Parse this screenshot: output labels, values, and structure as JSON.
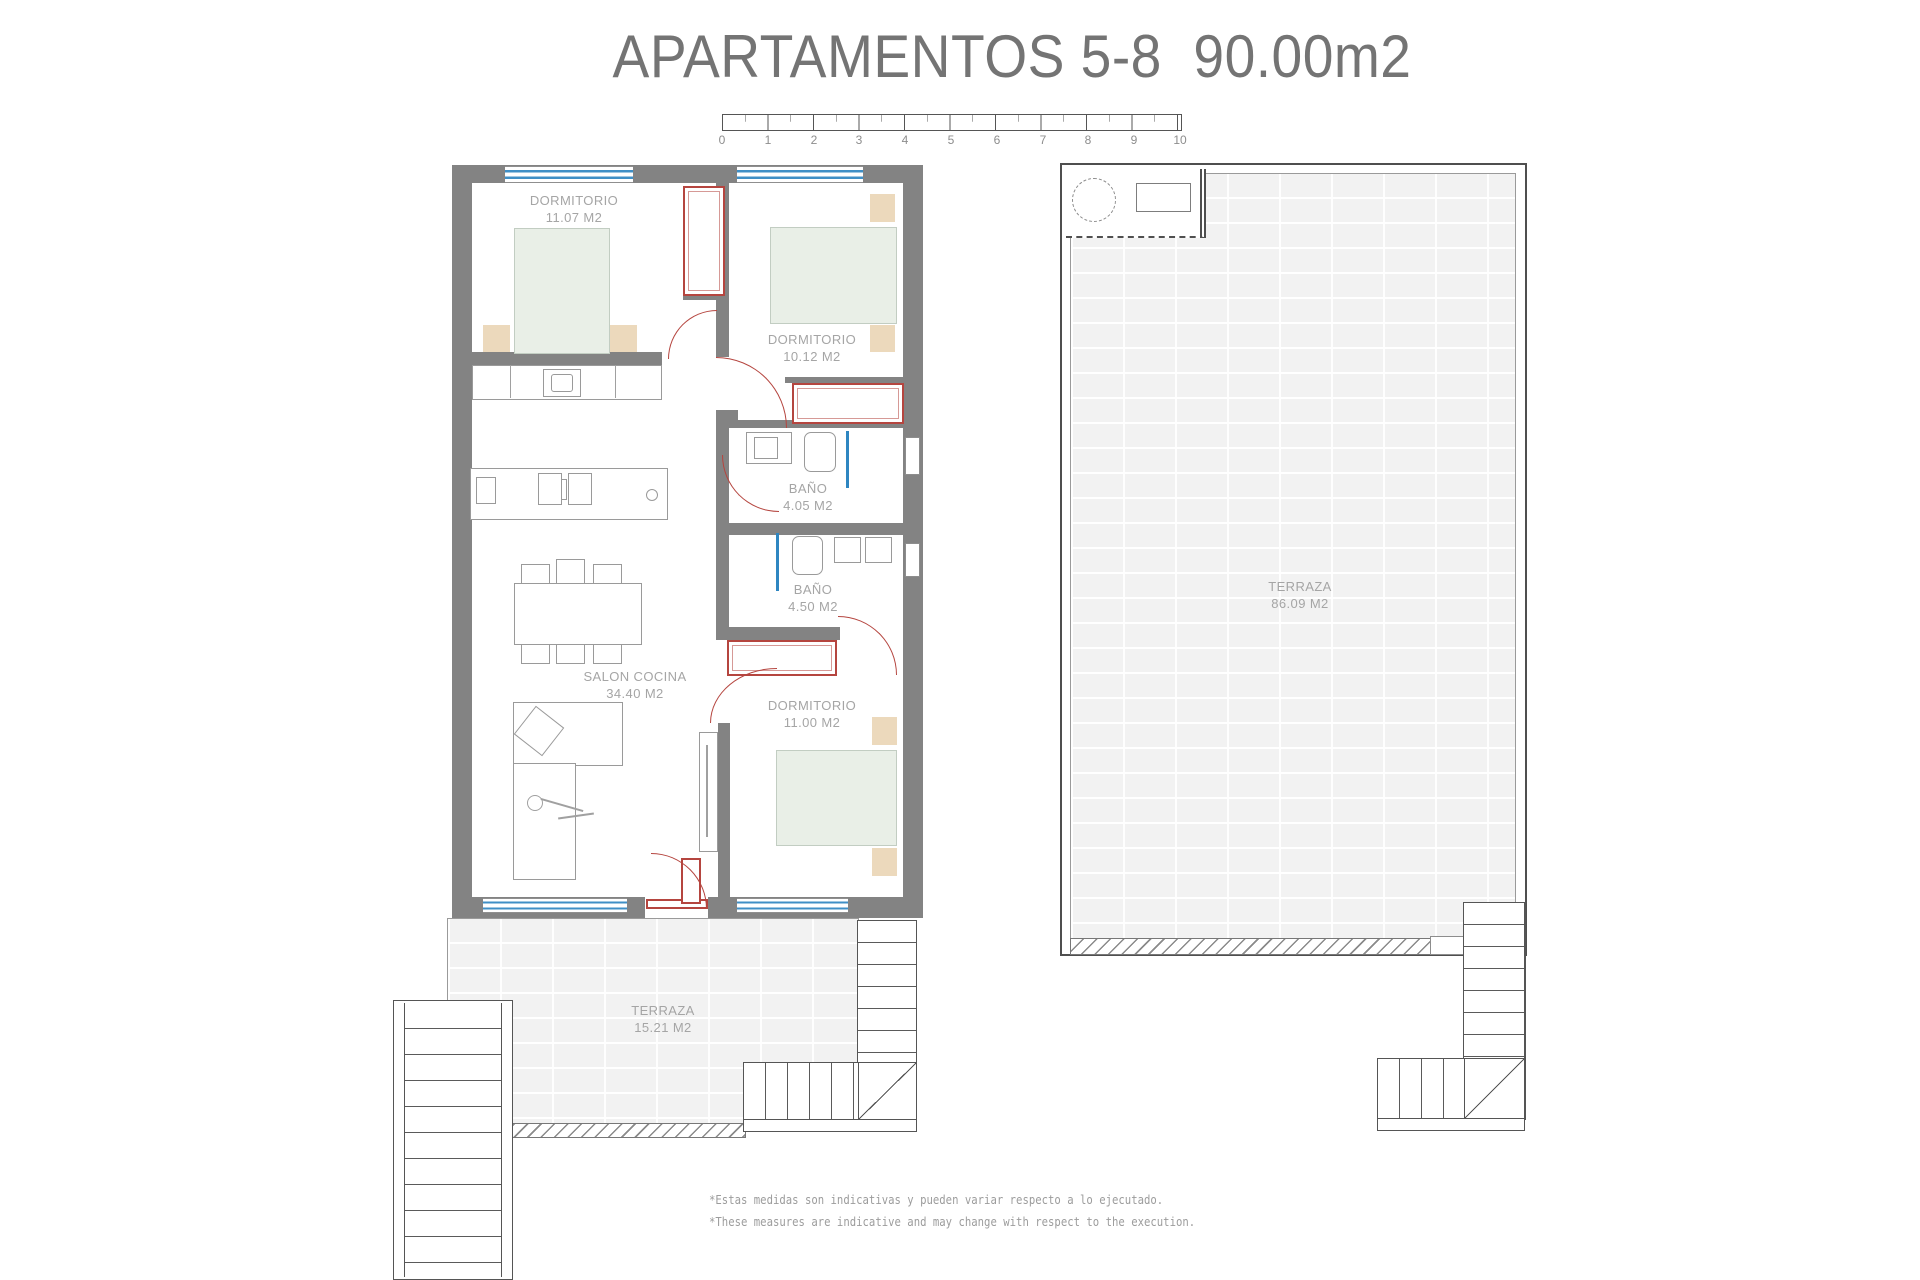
{
  "title": "APARTAMENTOS 5-8  90.00m2",
  "scale": {
    "ticks": [
      "0",
      "1",
      "2",
      "3",
      "4",
      "5",
      "6",
      "7",
      "8",
      "9",
      "10"
    ]
  },
  "rooms": {
    "bedroom1": {
      "label": "DORMITORIO",
      "area": "11.07 M2"
    },
    "bedroom2": {
      "label": "DORMITORIO",
      "area": "10.12 M2"
    },
    "bathroom1": {
      "label": "BAÑO",
      "area": "4.05 M2"
    },
    "bathroom2": {
      "label": "BAÑO",
      "area": "4.50 M2"
    },
    "living": {
      "label": "SALON COCINA",
      "area": "34.40 M2"
    },
    "bedroom3": {
      "label": "DORMITORIO",
      "area": "11.00 M2"
    },
    "terrace_ground": {
      "label": "TERRAZA",
      "area": "15.21 M2"
    },
    "terrace_solarium": {
      "label": "TERRAZA",
      "area": "86.09 M2"
    }
  },
  "footnotes": {
    "spanish": "*Estas medidas son indicativas y pueden variar respecto a lo ejecutado.",
    "english": "*These measures are indicative and may change with respect to the execution."
  },
  "colors": {
    "wall_gray": "#838383",
    "door_red": "#b5453f",
    "window_blue": "#3f8fc6",
    "bed_green": "#e9efe7",
    "wood_tan": "#ecd9bc",
    "terrace_fill": "#f2f2f2",
    "label_gray": "#a5a5a5"
  }
}
